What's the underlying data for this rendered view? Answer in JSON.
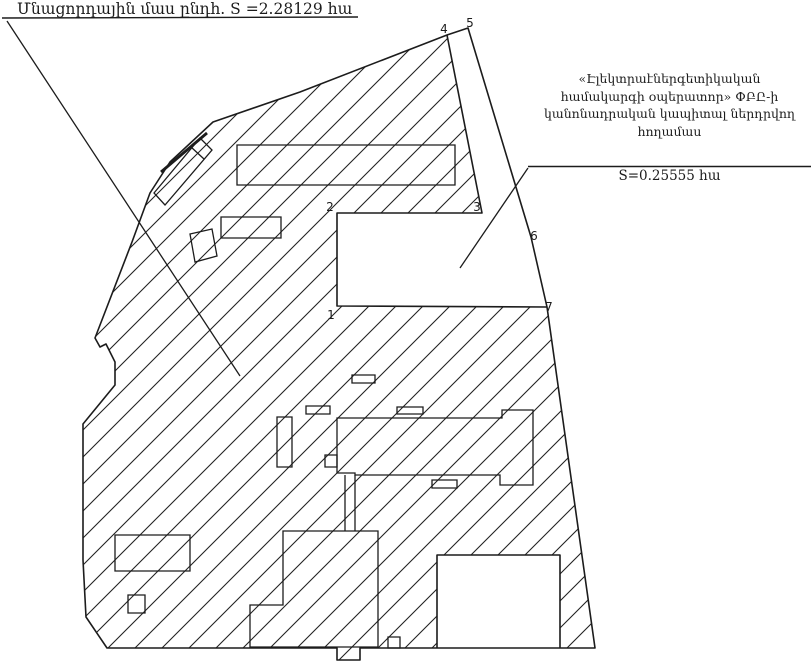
{
  "diagram": {
    "type": "cadastral-survey-plan",
    "colors": {
      "ink": "#1c1c1c",
      "background": "#ffffff"
    },
    "residual_parcel": {
      "label": "Մնացորդային մաս ընդհ. S =2.28129 հա",
      "area_ha": "2.28129"
    },
    "invested_parcel": {
      "label_lines": [
        "«Էլեկտրաէներգետիկական",
        "համակարգի օպերատոր» ՓԲԸ-ի",
        "կանոնադրական կապիտալ ներդրվող",
        "հողամաս"
      ],
      "area_label": "S=0.25555 հա",
      "area_ha": "0.25555"
    },
    "points": [
      {
        "label": "1"
      },
      {
        "label": "2"
      },
      {
        "label": "3"
      },
      {
        "label": "4"
      },
      {
        "label": "5"
      },
      {
        "label": "6"
      },
      {
        "label": "7"
      }
    ]
  }
}
